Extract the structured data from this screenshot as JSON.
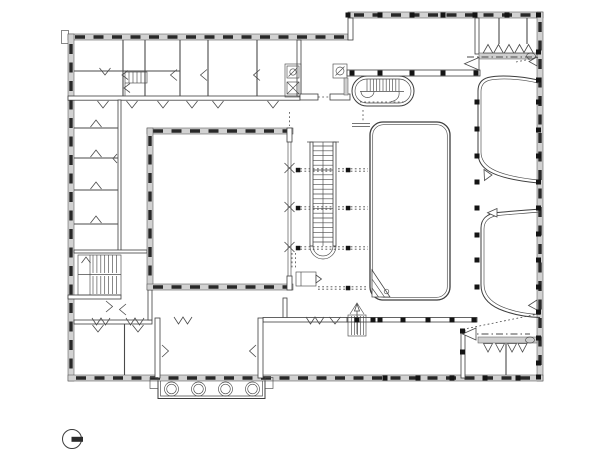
{
  "meta": {
    "title": "Architectural floor plan, ground level",
    "description": "Black ink architectural plan drawing of a public building with offices, a large square hall with folding partition, a rounded stage platform, fan-shaped side galleries, staircases, cloakrooms and a columned entrance portico",
    "drawing_type": "floor-plan"
  },
  "canvas": {
    "width": 600,
    "height": 466,
    "background": "#ffffff",
    "ink_color": "#3d3d3d",
    "window_dash_color": "#282828",
    "wall_band_fill": "#d2d2d2",
    "column_fill": "#141414"
  },
  "plan": {
    "elements": [
      {
        "name": "north-office-wing",
        "kind": "room-row",
        "note": "five cellular offices along the top edge with door swings"
      },
      {
        "name": "west-room-wing",
        "kind": "room-row",
        "note": "four small rooms off a vertical corridor"
      },
      {
        "name": "main-square-hall",
        "kind": "hall",
        "note": "large square hall with glazed walls"
      },
      {
        "name": "folding-partition",
        "kind": "partition",
        "note": "double-line movable wall with three X fold marks and dotted guide lines"
      },
      {
        "name": "straight-staircase",
        "kind": "stair",
        "note": "long straight run with rounded lower end"
      },
      {
        "name": "oval-staircase",
        "kind": "stair",
        "note": "stadium-shaped stair near upper foyer"
      },
      {
        "name": "dogleg-staircase",
        "kind": "stair",
        "note": "two-run stair in the west wing"
      },
      {
        "name": "stage-platform",
        "kind": "stage",
        "note": "tall rounded rectangle with corner access steps"
      },
      {
        "name": "upper-fan-gallery",
        "kind": "curved-room"
      },
      {
        "name": "lower-fan-gallery",
        "kind": "curved-room"
      },
      {
        "name": "upper-cloakroom",
        "kind": "cloakroom",
        "note": "counter band with five hook triangles and a wash basin oval"
      },
      {
        "name": "lower-cloakroom",
        "kind": "cloakroom",
        "note": "counter band with four hook triangles and a wash basin oval"
      },
      {
        "name": "entrance-hall",
        "kind": "vestibule"
      },
      {
        "name": "portico",
        "kind": "porch",
        "note": "four round columns below the south facade"
      },
      {
        "name": "kitchenette-fixtures",
        "kind": "fixture",
        "note": "stove and sink squares at east end of office wing"
      },
      {
        "name": "north-arrow",
        "kind": "symbol",
        "note": "circle with solid bar, lower left corner"
      }
    ],
    "column_grid": "black square columns along east wall, colonnade lines and partition guide lines",
    "window_symbol": "thick dark dashes inside grey wall bands"
  }
}
